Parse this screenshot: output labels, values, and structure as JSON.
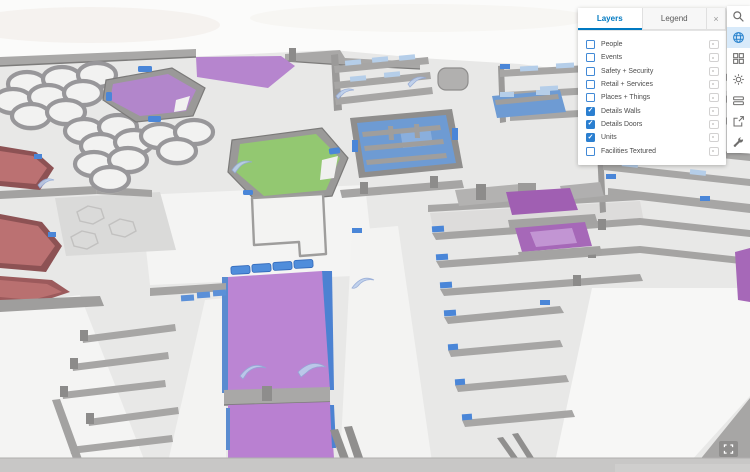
{
  "panel": {
    "tabs": [
      {
        "label": "Layers",
        "active": true
      },
      {
        "label": "Legend",
        "active": false
      }
    ],
    "close_label": "×",
    "checkmark": "✓",
    "layers": [
      {
        "label": "People",
        "checked": false
      },
      {
        "label": "Events",
        "checked": false
      },
      {
        "label": "Safety + Security",
        "checked": false
      },
      {
        "label": "Retail + Services",
        "checked": false
      },
      {
        "label": "Places + Things",
        "checked": false
      },
      {
        "label": "Details Walls",
        "checked": true
      },
      {
        "label": "Details Doors",
        "checked": true
      },
      {
        "label": "Units",
        "checked": true
      },
      {
        "label": "Facilities Textured",
        "checked": false
      }
    ]
  },
  "toolbar": {
    "buttons": [
      {
        "name": "search",
        "active": false
      },
      {
        "name": "globe",
        "active": true
      },
      {
        "name": "basemap-grid",
        "active": false
      },
      {
        "name": "daylight-sun",
        "active": false
      },
      {
        "name": "gallery",
        "active": false
      },
      {
        "name": "share",
        "active": false
      },
      {
        "name": "tools",
        "active": false
      }
    ]
  },
  "colors": {
    "accent_blue": "#0079c1",
    "checkbox_blue": "#2b7fd0",
    "selected_tool_bg": "#d8eafa",
    "unit_purple": "#b885d2",
    "unit_green": "#93c871",
    "unit_blue": "#6e9bd3",
    "unit_red": "#bb7172",
    "door_blue": "#4a86d8",
    "wall_gray": "#9a9998"
  }
}
